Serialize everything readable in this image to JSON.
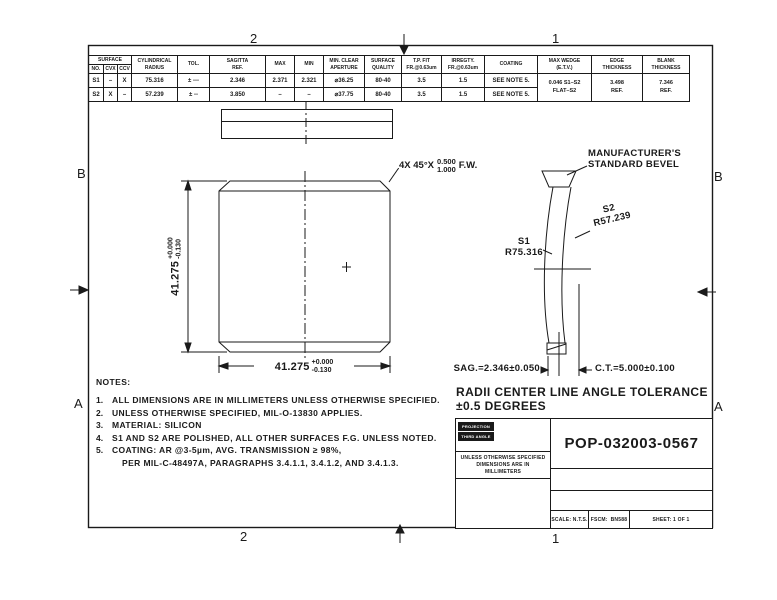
{
  "zones": {
    "top_2": "2",
    "top_1": "1",
    "bottom_2": "2",
    "bottom_1": "1",
    "left_b": "B",
    "left_a": "A",
    "right_b": "B",
    "right_a": "A"
  },
  "spec_table": {
    "group_surface": "SURFACE",
    "h_no": "NO.",
    "h_cvx": "CVX",
    "h_ccv": "CCV",
    "h_radius_1": "CYLINDRICAL",
    "h_radius_2": "RADIUS",
    "h_tol": "TOL.",
    "h_sag_1": "SAGITTA",
    "h_sag_2": "REF.",
    "h_max": "MAX",
    "h_min": "MIN",
    "h_aperture_1": "MIN. CLEAR",
    "h_aperture_2": "APERTURE",
    "h_quality_1": "SURFACE",
    "h_quality_2": "QUALITY",
    "h_tp_1": "T.P. FIT",
    "h_tp_2": "FR.@0.63um",
    "h_irreg_1": "IRREGTY.",
    "h_irreg_2": "FR.@0.63um",
    "h_coating": "COATING",
    "h_wedge_1": "MAX WEDGE",
    "h_wedge_2": "(E.T.V.)",
    "h_edge_1": "EDGE",
    "h_edge_2": "THICKNESS",
    "h_blank_1": "BLANK",
    "h_blank_2": "THICKNESS",
    "rows": [
      {
        "no": "S1",
        "cvx": "–",
        "ccv": "X",
        "radius": "75.316",
        "tol": "± ---",
        "sag_ref": "2.346",
        "max": "2.371",
        "min": "2.321",
        "aperture": "⌀36.25",
        "quality": "80-40",
        "tp_fit": "3.5",
        "irregularity": "1.5",
        "coating": "SEE NOTE 5."
      },
      {
        "no": "S2",
        "cvx": "X",
        "ccv": "–",
        "radius": "57.239",
        "tol": "± --",
        "sag_ref": "3.850",
        "max": "–",
        "min": "–",
        "aperture": "⌀37.75",
        "quality": "80-40",
        "tp_fit": "3.5",
        "irregularity": "1.5",
        "coating": "SEE NOTE 5."
      }
    ],
    "wedge_value_1": "0.046 S1–S2",
    "wedge_value_2": "FLAT–S2",
    "edge_value_1": "3.498",
    "edge_value_2": "REF.",
    "blank_value_1": "7.346",
    "blank_value_2": "REF."
  },
  "front_view": {
    "chamfer_prefix": "4X  45°X",
    "chamfer_num": "0.500",
    "chamfer_den": "1.000",
    "chamfer_suffix": "F.W.",
    "dim_value": "41.275",
    "dim_plus": "+0.000",
    "dim_minus": "-0.130"
  },
  "side_view": {
    "bevel_line_1": "MANUFACTURER'S",
    "bevel_line_2": "STANDARD BEVEL",
    "s2_name": "S2",
    "s2_radius": "R57.239",
    "s1_name": "S1",
    "s1_radius": "R75.316",
    "sag": "SAG.=2.346±0.050",
    "ct": "C.T.=5.000±0.100",
    "radii_note_1": "RADII CENTER LINE ANGLE TOLERANCE",
    "radii_note_2": "±0.5 DEGREES"
  },
  "notes": {
    "title": "NOTES:",
    "items": [
      {
        "num": "1.",
        "text": "ALL DIMENSIONS ARE IN MILLIMETERS UNLESS OTHERWISE SPECIFIED."
      },
      {
        "num": "2.",
        "text": "UNLESS OTHERWISE SPECIFIED, MIL-O-13830 APPLIES."
      },
      {
        "num": "3.",
        "text": "MATERIAL: SILICON"
      },
      {
        "num": "4.",
        "text": "S1 AND S2 ARE POLISHED, ALL OTHER SURFACES F.G. UNLESS NOTED."
      },
      {
        "num": "5.",
        "text": "COATING: AR @3-5µm, AVG. TRANSMISSION ≥ 98%,"
      },
      {
        "num": "",
        "text": "PER MIL-C-48497A, PARAGRAPHS 3.4.1.1, 3.4.1.2, AND 3.4.1.3."
      }
    ]
  },
  "title_block": {
    "chip_projection": "PROJECTION",
    "chip_third_angle": "THIRD ANGLE",
    "uos_1": "UNLESS OTHERWISE SPECIFIED",
    "uos_2": "DIMENSIONS ARE IN",
    "uos_3": "MILLIMETERS",
    "part_number": "POP-032003-0567",
    "scale": "SCALE: N.T.S.",
    "fscm_label": "FSCM:",
    "fscm_value": "BN588",
    "sheet": "SHEET: 1 OF 1"
  }
}
